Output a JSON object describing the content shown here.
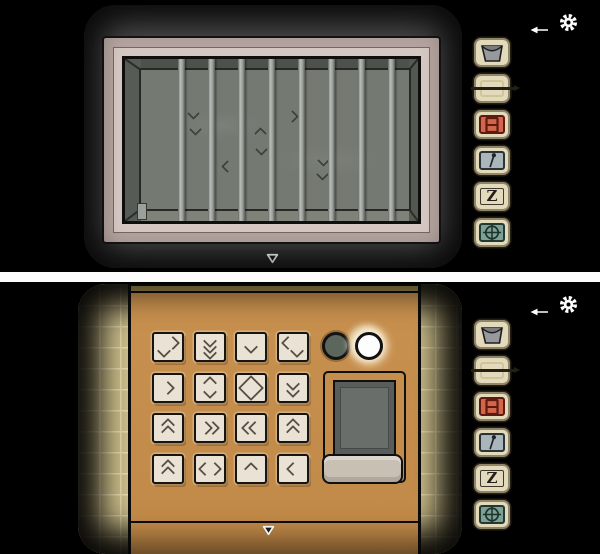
{
  "ui": {
    "divider_color": "#fcfcfc",
    "background_color": "#000000",
    "nav": {
      "arrow_item_icon": "arrow-icon",
      "settings_icon": "gear-icon",
      "down_nav_icon": "down-arrow-icon"
    }
  },
  "inventory": {
    "items": [
      {
        "name": "bucket",
        "icon": "bucket-icon",
        "color": "#97999c"
      },
      {
        "name": "empty frame with needle",
        "icon": "frame-needle-icon",
        "color": "#e3dabc"
      },
      {
        "name": "red hatch tile",
        "icon": "red-hatch-icon",
        "color": "#d2654a"
      },
      {
        "name": "pin",
        "icon": "pin-icon",
        "color": "#a9b6bb"
      },
      {
        "name": "letter Z tile",
        "icon": "letter-z-icon",
        "label": "Z",
        "color": "#e3dabc"
      },
      {
        "name": "crosshair seal tile",
        "icon": "crosshair-icon",
        "color": "#7da195"
      }
    ]
  },
  "top_screen": {
    "scene": "barred window over dark wall",
    "window": {
      "bars": 9,
      "frame_color_outer": "#b3a39e",
      "frame_color_inner": "#d5c7c1",
      "wall_color": "#747971",
      "wall_marks": [
        {
          "dir": "down",
          "x": 64,
          "y": 50
        },
        {
          "dir": "down",
          "x": 66,
          "y": 66
        },
        {
          "dir": "up",
          "x": 131,
          "y": 70
        },
        {
          "dir": "down",
          "x": 132,
          "y": 86
        },
        {
          "dir": "right",
          "x": 163,
          "y": 53
        },
        {
          "dir": "left",
          "x": 98,
          "y": 103
        },
        {
          "dir": "down",
          "x": 194,
          "y": 97
        },
        {
          "dir": "down",
          "x": 193,
          "y": 111
        }
      ]
    }
  },
  "bottom_screen": {
    "scene": "wooden keypad panel with tiled wall",
    "panel_color": "#c9914f",
    "tile_color": "#cfc08c",
    "keypad": {
      "rows": 4,
      "cols": 4,
      "buttons": [
        {
          "id": "r1c1",
          "symbol": "down-and-right",
          "glyphs": [
            {
              "dir": "right",
              "x": 5,
              "y": -4
            },
            {
              "dir": "down",
              "x": -4,
              "y": 4
            }
          ]
        },
        {
          "id": "r1c2",
          "symbol": "triple-down",
          "glyphs": [
            {
              "dir": "down",
              "x": 0,
              "y": -6
            },
            {
              "dir": "down",
              "x": 0,
              "y": 0
            },
            {
              "dir": "down",
              "x": 0,
              "y": 6
            }
          ]
        },
        {
          "id": "r1c3",
          "symbol": "down",
          "glyphs": [
            {
              "dir": "down",
              "x": 0,
              "y": 0
            }
          ]
        },
        {
          "id": "r1c4",
          "symbol": "left-and-down",
          "glyphs": [
            {
              "dir": "left",
              "x": -5,
              "y": -4
            },
            {
              "dir": "down",
              "x": 4,
              "y": 4
            }
          ]
        },
        {
          "id": "r2c1",
          "symbol": "right",
          "glyphs": [
            {
              "dir": "right",
              "x": 0,
              "y": 0
            }
          ]
        },
        {
          "id": "r2c2",
          "symbol": "up-down",
          "glyphs": [
            {
              "dir": "up",
              "x": 0,
              "y": -5
            },
            {
              "dir": "down",
              "x": 0,
              "y": 4
            }
          ]
        },
        {
          "id": "r2c3",
          "symbol": "diamond",
          "glyphs": [
            {
              "dir": "up",
              "x": 0,
              "y": -6
            },
            {
              "dir": "right",
              "x": 6,
              "y": 0
            },
            {
              "dir": "down",
              "x": 0,
              "y": 6
            },
            {
              "dir": "left",
              "x": -6,
              "y": 0
            }
          ]
        },
        {
          "id": "r2c4",
          "symbol": "double-down",
          "glyphs": [
            {
              "dir": "down",
              "x": 0,
              "y": -4
            },
            {
              "dir": "down",
              "x": 0,
              "y": 3
            }
          ]
        },
        {
          "id": "r3c1",
          "symbol": "double-up",
          "glyphs": [
            {
              "dir": "up",
              "x": 0,
              "y": -3
            },
            {
              "dir": "up",
              "x": 0,
              "y": 4
            }
          ]
        },
        {
          "id": "r3c2",
          "symbol": "double-right",
          "glyphs": [
            {
              "dir": "right",
              "x": -4,
              "y": 0
            },
            {
              "dir": "right",
              "x": 3,
              "y": 0
            }
          ]
        },
        {
          "id": "r3c3",
          "symbol": "double-left",
          "glyphs": [
            {
              "dir": "left",
              "x": -3,
              "y": 0
            },
            {
              "dir": "left",
              "x": 4,
              "y": 0
            }
          ]
        },
        {
          "id": "r3c4",
          "symbol": "double-up",
          "glyphs": [
            {
              "dir": "up",
              "x": 0,
              "y": -3
            },
            {
              "dir": "up",
              "x": 0,
              "y": 4
            }
          ]
        },
        {
          "id": "r4c1",
          "symbol": "double-up",
          "glyphs": [
            {
              "dir": "up",
              "x": 0,
              "y": -3
            },
            {
              "dir": "up",
              "x": 0,
              "y": 4
            }
          ]
        },
        {
          "id": "r4c2",
          "symbol": "left-right",
          "glyphs": [
            {
              "dir": "left",
              "x": -5,
              "y": 0
            },
            {
              "dir": "right",
              "x": 5,
              "y": 0
            }
          ]
        },
        {
          "id": "r4c3",
          "symbol": "up",
          "glyphs": [
            {
              "dir": "up",
              "x": 0,
              "y": 0
            }
          ]
        },
        {
          "id": "r4c4",
          "symbol": "left",
          "glyphs": [
            {
              "dir": "left",
              "x": 0,
              "y": 0
            }
          ]
        }
      ]
    },
    "lights": [
      {
        "name": "left-light",
        "state": "off",
        "color": "#5b665c"
      },
      {
        "name": "right-light",
        "state": "on",
        "color": "#fdfdfd"
      }
    ],
    "hatch": {
      "screen_color": "#585c5a",
      "tray_color": "#c8c0b3"
    }
  }
}
